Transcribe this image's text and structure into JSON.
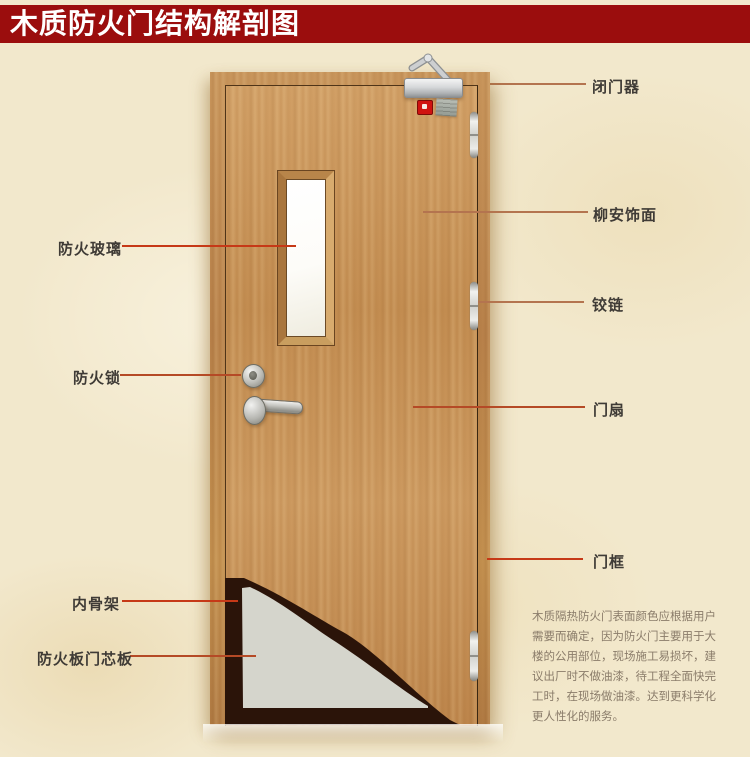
{
  "title": {
    "text": "木质防火门结构解剖图"
  },
  "colors": {
    "title-bg": "#9b0d0d",
    "title-fg": "#ffffff",
    "line-muted": "#b4744f",
    "line-mid": "#b54a26",
    "line-bright": "#c63917",
    "label-fg": "#3f3b36",
    "note-fg": "#8a7c6a",
    "door-wood": "#c6945a",
    "core-gray": "#d5d5cc",
    "skeleton-dark": "#2b1409"
  },
  "labels_right": [
    {
      "id": "door-closer",
      "text": "闭门器"
    },
    {
      "id": "lauan-veneer",
      "text": "柳安饰面"
    },
    {
      "id": "hinge",
      "text": "铰链"
    },
    {
      "id": "door-leaf",
      "text": "门扇"
    },
    {
      "id": "door-frame",
      "text": "门框"
    }
  ],
  "labels_left": [
    {
      "id": "fire-glass",
      "text": "防火玻璃"
    },
    {
      "id": "fire-lock",
      "text": "防火锁"
    },
    {
      "id": "inner-skeleton",
      "text": "内骨架"
    },
    {
      "id": "fire-board-core",
      "text": "防火板门芯板"
    }
  ],
  "note": {
    "text": "木质隔热防火门表面颜色应根据用户需要而确定，因为防火门主要用于大楼的公用部位，现场施工易损坏，建议出厂时不做油漆，待工程全面快完工时，在现场做油漆。达到更科学化更人性化的服务。"
  },
  "parts": [
    "door-closer",
    "status-indicator-light",
    "product-sticker",
    "fire-glass-window",
    "fire-lock-cylinder",
    "lever-handle",
    "hinge",
    "door-leaf",
    "door-frame",
    "inner-skeleton-cutaway",
    "fire-board-core-cutaway"
  ]
}
